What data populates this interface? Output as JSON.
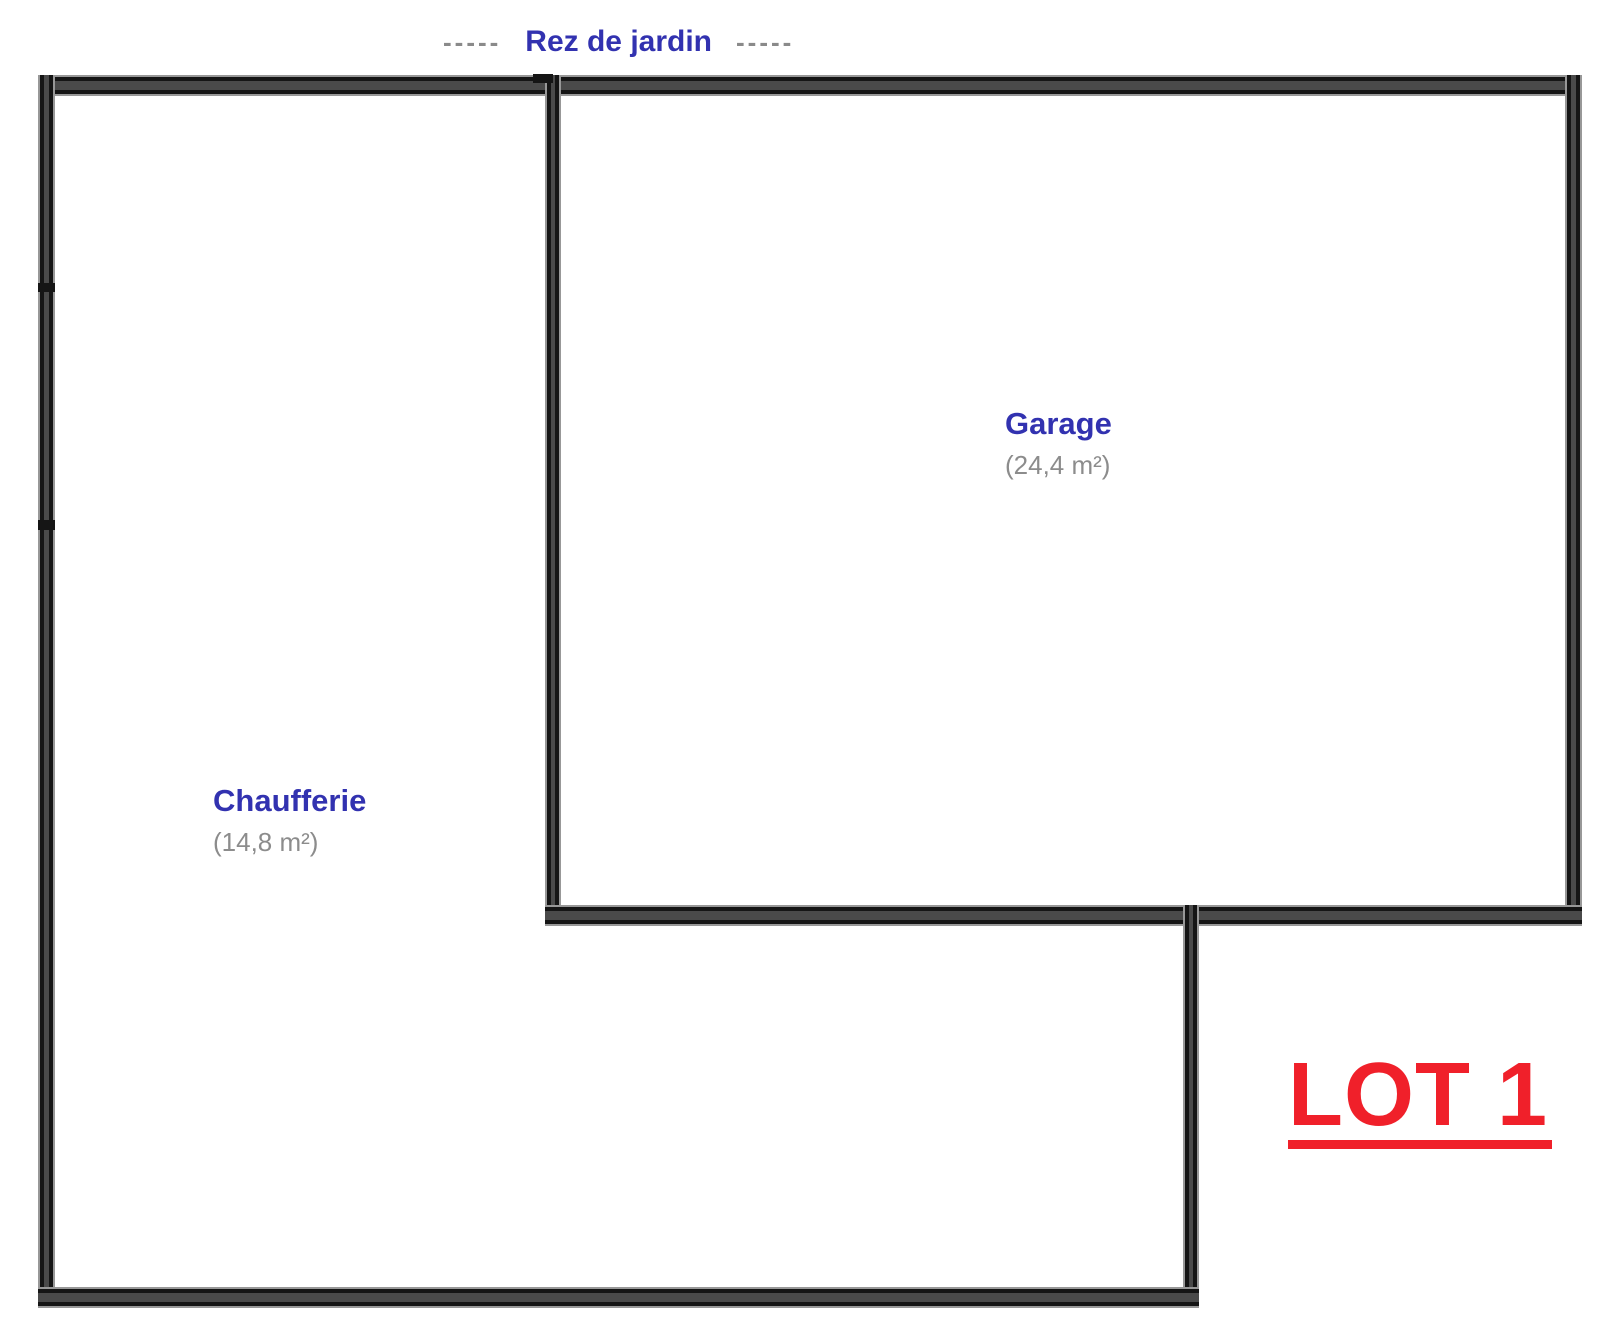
{
  "title": {
    "dashes_left": "-----",
    "text": "Rez de jardin",
    "dashes_right": "-----"
  },
  "floor_plan": {
    "level_name": "Rez de jardin",
    "rooms": [
      {
        "name": "Garage",
        "area": "(24,4 m²)"
      },
      {
        "name": "Chaufferie",
        "area": "(14,8 m²)"
      }
    ]
  },
  "lot": {
    "text": "LOT 1"
  },
  "colors": {
    "label-blue": "#3232b0",
    "area-gray": "#8c8c8c",
    "dash-gray": "#8a8a8a",
    "lot-red": "#f0202a",
    "wall-core": "#4a4a4a",
    "wall-edge": "#151515",
    "wall-bevel": "#989898"
  }
}
